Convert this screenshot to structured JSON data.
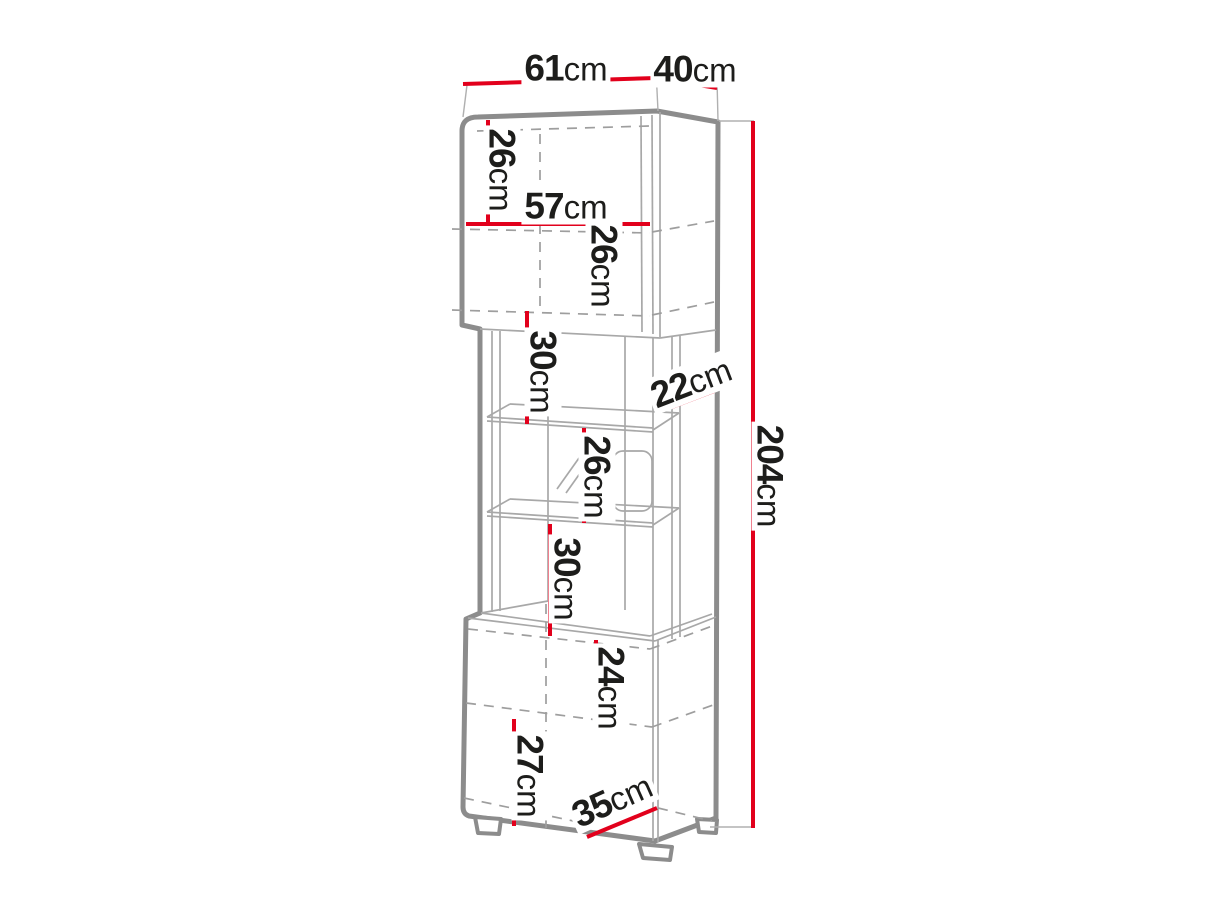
{
  "diagram": {
    "type": "furniture-dimension-diagram",
    "subject": "tall-display-cabinet",
    "unit": "cm"
  },
  "colors": {
    "dimension_red": "#e2001c",
    "outline_gray": "#8c8c8c",
    "text_black": "#1d1d1b"
  },
  "labels": {
    "top_width": {
      "num": "61",
      "unit": "cm"
    },
    "top_depth": {
      "num": "40",
      "unit": "cm"
    },
    "upper_compartment_1": {
      "num": "26",
      "unit": "cm"
    },
    "interior_width": {
      "num": "57",
      "unit": "cm"
    },
    "upper_compartment_2": {
      "num": "26",
      "unit": "cm"
    },
    "open_shelf_space_1": {
      "num": "30",
      "unit": "cm"
    },
    "open_section_depth": {
      "num": "22",
      "unit": "cm"
    },
    "glass_compartment": {
      "num": "26",
      "unit": "cm"
    },
    "open_shelf_space_2": {
      "num": "30",
      "unit": "cm"
    },
    "total_height": {
      "num": "204",
      "unit": "cm"
    },
    "lower_compartment_1": {
      "num": "24",
      "unit": "cm"
    },
    "lower_compartment_2": {
      "num": "27",
      "unit": "cm"
    },
    "bottom_depth": {
      "num": "35",
      "unit": "cm"
    }
  }
}
